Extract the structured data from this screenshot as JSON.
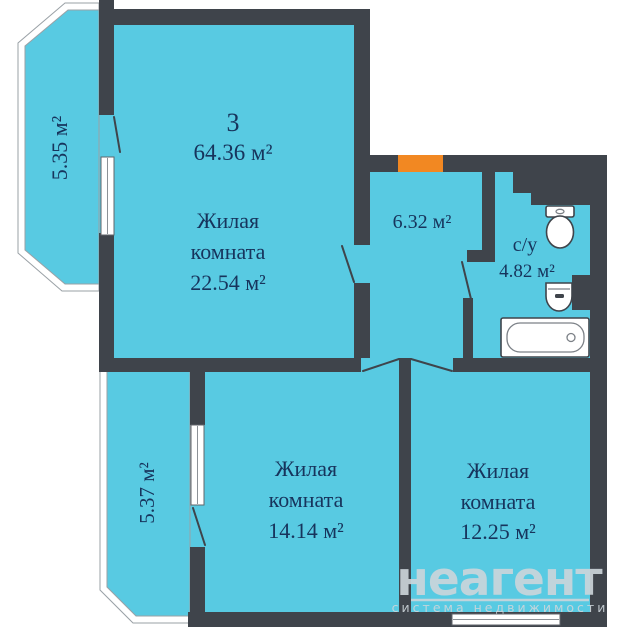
{
  "plan": {
    "summary": {
      "rooms_count": "3",
      "total_area": "64.36 м²"
    },
    "rooms": {
      "living_main": {
        "line1": "Жилая",
        "line2": "комната",
        "area": "22.54 м²"
      },
      "hall": {
        "area": "6.32 м²"
      },
      "bathroom": {
        "label": "с/у",
        "area": "4.82 м²"
      },
      "living_mid": {
        "line1": "Жилая",
        "line2": "комната",
        "area": "14.14 м²"
      },
      "living_right": {
        "line1": "Жилая",
        "line2": "комната",
        "area": "12.25 м²"
      },
      "balcony_top": {
        "area": "5.35 м²"
      },
      "balcony_bottom": {
        "area": "5.37 м²"
      }
    },
    "fixtures": [
      "toilet",
      "sink",
      "bathtub"
    ],
    "entrance": {
      "type": "entrance-door",
      "color": "#f28822"
    },
    "watermark": {
      "brand": "неагент",
      "tagline": "система недвижимости"
    },
    "colors": {
      "wall": "#3f444b",
      "room_fill": "#58cae2",
      "entrance_door": "#f28822",
      "label_text": "#17345c",
      "watermark": "#cdd6db",
      "background": "#ffffff"
    }
  }
}
